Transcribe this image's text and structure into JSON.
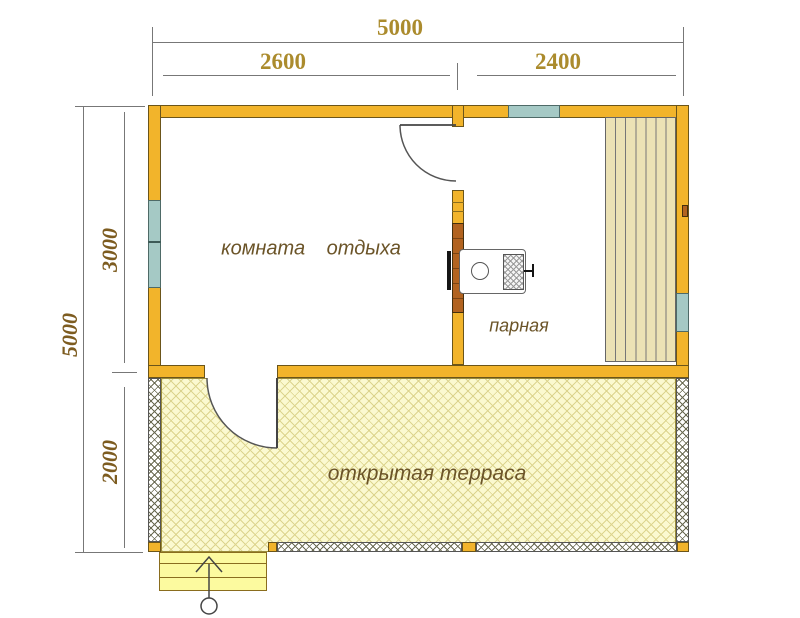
{
  "plan": {
    "title_hidden": "",
    "dimensions": {
      "top_total": "5000",
      "top_segments": [
        {
          "label": "2600"
        },
        {
          "label": "2400"
        }
      ],
      "left_total": "5000",
      "left_segments": [
        {
          "label": "3000"
        },
        {
          "label": "2000"
        }
      ]
    },
    "rooms": [
      {
        "id": "rest-room",
        "label": "комната отдыха"
      },
      {
        "id": "steam-room",
        "label": "парная"
      },
      {
        "id": "terrace",
        "label": "открытая терраса"
      }
    ]
  },
  "colors": {
    "wall": "#F2B42B",
    "wall_outline": "#6B551A",
    "window": "#A5C9C5",
    "brick": "#B26320",
    "bench_plank": "#ECE2B5",
    "terrace_fill": "#FBF9D0",
    "terrace_hatch": "#DCD48E",
    "stairs_fill": "#FCFA9F",
    "dim_line": "#777777",
    "dim_top_text": "#AB8B2D",
    "dim_left_text": "#7D5C20",
    "room_label": "#6B5428"
  }
}
